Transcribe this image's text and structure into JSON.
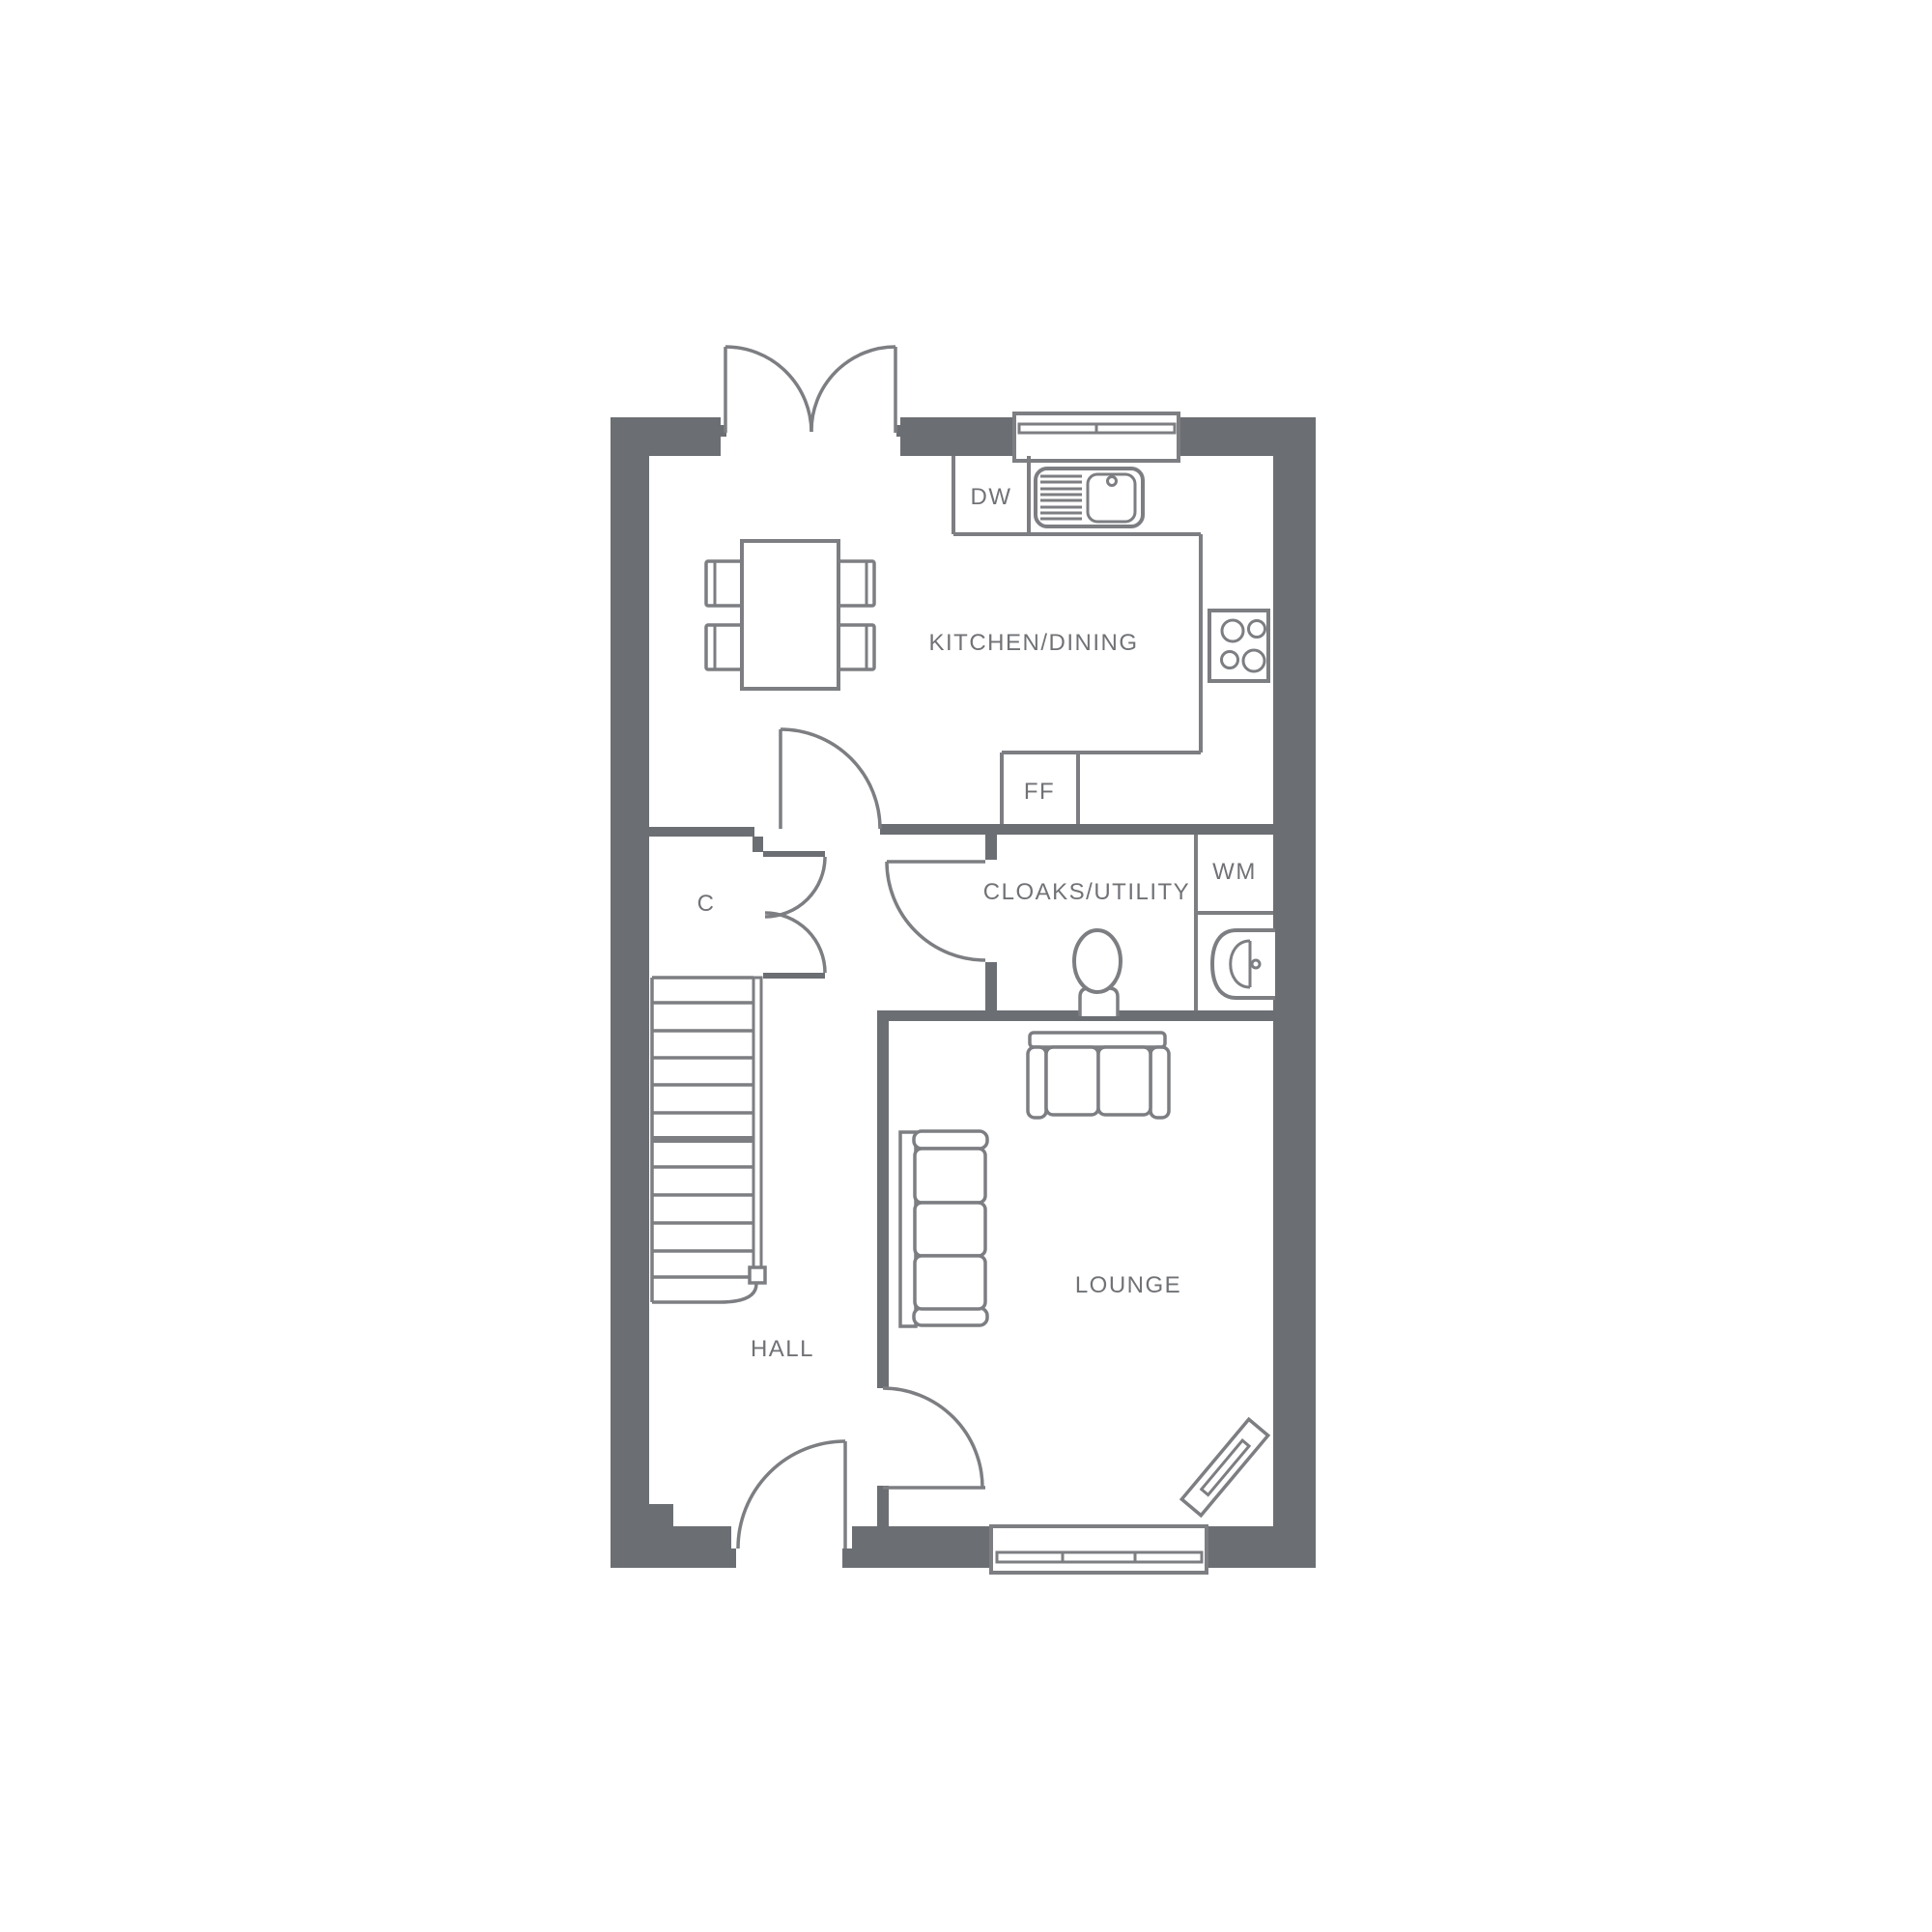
{
  "plan": {
    "type": "floor-plan",
    "floor": "ground-floor",
    "rooms": [
      {
        "id": "kitchen_dining",
        "label": "KITCHEN/DINING"
      },
      {
        "id": "cloaks_utility",
        "label": "CLOAKS/UTILITY"
      },
      {
        "id": "lounge",
        "label": "LOUNGE"
      },
      {
        "id": "hall",
        "label": "HALL"
      },
      {
        "id": "closet",
        "label": "C"
      }
    ],
    "appliances": [
      {
        "id": "dishwasher",
        "label": "DW"
      },
      {
        "id": "fridge_freezer",
        "label": "FF"
      },
      {
        "id": "washing_machine",
        "label": "WM"
      }
    ],
    "colors": {
      "wall": "#6b6e73",
      "line": "#7c7e82",
      "text": "#707276",
      "background": "#ffffff"
    }
  }
}
